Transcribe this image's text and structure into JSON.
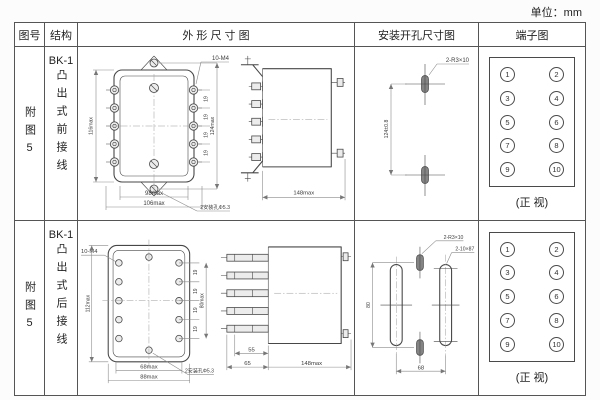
{
  "page": {
    "unit_label": "单位：mm"
  },
  "table": {
    "headers": {
      "fig_no": "图号",
      "structure": "结构",
      "outline": "外 形 尺 寸 图",
      "mounting": "安装开孔尺寸图",
      "terminal": "端子图"
    }
  },
  "rows": [
    {
      "fig_no": "附图5",
      "structure_model": "BK-1",
      "structure_desc": "凸出式前接线",
      "outline": {
        "front": {
          "height": "116max",
          "thread": "10-M4",
          "pitch": [
            "19",
            "19",
            "19",
            "19"
          ],
          "side_height": "124max",
          "width_inner": "98max",
          "width_outer": "106max",
          "hole_note": "2安装孔Φ5.3"
        },
        "side": {
          "depth": "148max"
        }
      },
      "mounting": {
        "slot_label": "2-R3×10",
        "spacing": "124±0.8"
      },
      "terminal": {
        "left": [
          "1",
          "3",
          "5",
          "7",
          "9"
        ],
        "right": [
          "2",
          "4",
          "6",
          "8",
          "10"
        ],
        "caption": "(正 视)"
      }
    },
    {
      "fig_no": "附图5",
      "structure_model": "BK-1",
      "structure_desc": "凸出式后接线",
      "outline": {
        "front": {
          "thread": "10-M4",
          "height": "112max",
          "pitch": [
            "19",
            "19",
            "19",
            "19"
          ],
          "side_height": "80max",
          "width_inner": "68max",
          "width_outer": "88max",
          "hole_note": "2安装孔Φ5.3"
        },
        "side": {
          "stud_len": "55",
          "offset": "65",
          "depth": "148max"
        }
      },
      "mounting": {
        "slot_small_label": "2-R3×10",
        "slot_long_label": "2-10×87",
        "height": "80",
        "spacing": "68"
      },
      "terminal": {
        "left": [
          "1",
          "3",
          "5",
          "7",
          "9"
        ],
        "right": [
          "2",
          "4",
          "6",
          "8",
          "10"
        ],
        "caption": "(正 视)"
      }
    }
  ]
}
